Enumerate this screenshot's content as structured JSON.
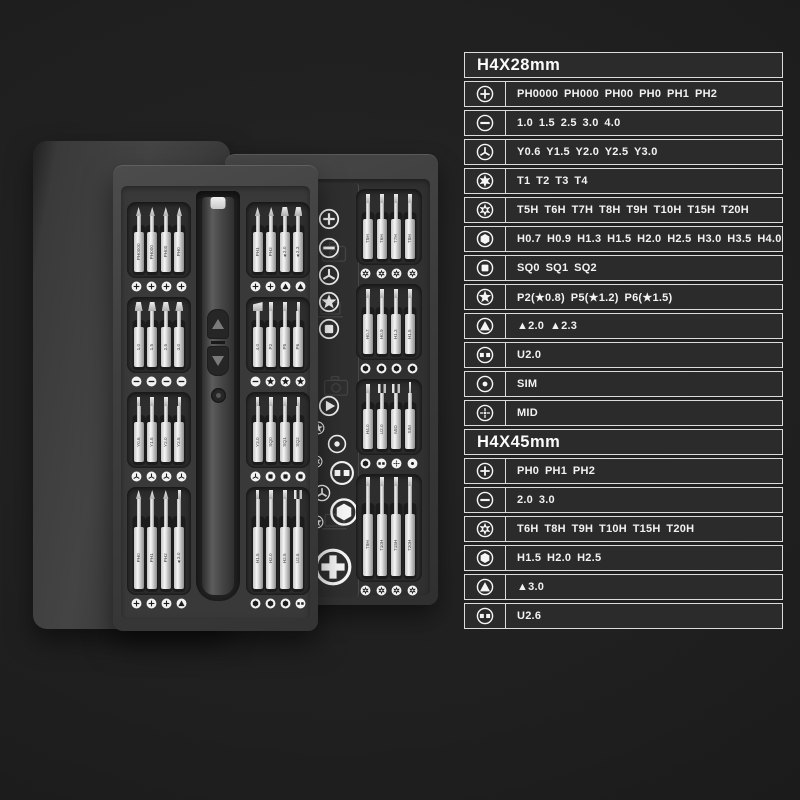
{
  "colors": {
    "background": "#1f1f1f",
    "case_panel": "#3a3a3a",
    "table_background": "#2b2b2b",
    "table_border": "#dcdcdc",
    "table_text": "#f2f2f2",
    "bit_metal": "#e8e8e8"
  },
  "product": {
    "spec_tables": [
      {
        "title": "H4X28mm",
        "rows": [
          {
            "icon": "phillips",
            "text": "PH0000 PH000 PH00 PH0 PH1 PH2"
          },
          {
            "icon": "slotted",
            "text": "1.0 1.5 2.5 3.0 4.0"
          },
          {
            "icon": "y-type",
            "text": "Y0.6 Y1.5 Y2.0 Y2.5 Y3.0"
          },
          {
            "icon": "torx",
            "text": "T1 T2 T3 T4"
          },
          {
            "icon": "torx-security",
            "text": "T5H T6H T7H T8H T9H T10H T15H T20H"
          },
          {
            "icon": "hex",
            "text": "H0.7 H0.9 H1.3 H1.5 H2.0 H2.5 H3.0 H3.5 H4.0"
          },
          {
            "icon": "square",
            "text": "SQ0 SQ1 SQ2"
          },
          {
            "icon": "pentalobe",
            "text": "P2(★0.8) P5(★1.2) P6(★1.5)"
          },
          {
            "icon": "triangle",
            "text": "▲2.0 ▲2.3"
          },
          {
            "icon": "u-type",
            "text": "U2.0"
          },
          {
            "icon": "sim",
            "text": "SIM"
          },
          {
            "icon": "mid",
            "text": "MID"
          }
        ]
      },
      {
        "title": "H4X45mm",
        "rows": [
          {
            "icon": "phillips",
            "text": "PH0 PH1 PH2"
          },
          {
            "icon": "slotted",
            "text": "2.0 3.0"
          },
          {
            "icon": "torx-security",
            "text": "T6H T8H T9H T10H T15H T20H"
          },
          {
            "icon": "hex",
            "text": "H1.5 H2.0 H2.5"
          },
          {
            "icon": "triangle",
            "text": "▲3.0"
          },
          {
            "icon": "u-type",
            "text": "U2.6"
          }
        ]
      }
    ],
    "front_case": {
      "left_rows": [
        {
          "tall": false,
          "bits": [
            {
              "label": "PH0000",
              "tip": "point",
              "icon": "phillips"
            },
            {
              "label": "PH000",
              "tip": "point",
              "icon": "phillips"
            },
            {
              "label": "PH00",
              "tip": "point",
              "icon": "phillips"
            },
            {
              "label": "PH0",
              "tip": "point",
              "icon": "phillips"
            }
          ]
        },
        {
          "tall": false,
          "bits": [
            {
              "label": "1.0",
              "tip": "flat",
              "icon": "slotted"
            },
            {
              "label": "1.5",
              "tip": "flat",
              "icon": "slotted"
            },
            {
              "label": "2.5",
              "tip": "flat",
              "icon": "slotted"
            },
            {
              "label": "3.0",
              "tip": "flat",
              "icon": "slotted"
            }
          ]
        },
        {
          "tall": false,
          "bits": [
            {
              "label": "Y0.6",
              "tip": "rod",
              "icon": "y-type"
            },
            {
              "label": "Y1.5",
              "tip": "rod",
              "icon": "y-type"
            },
            {
              "label": "Y2.0",
              "tip": "rod",
              "icon": "y-type"
            },
            {
              "label": "Y2.5",
              "tip": "rod",
              "icon": "y-type"
            }
          ]
        },
        {
          "tall": true,
          "bits": [
            {
              "label": "PH0",
              "tip": "point",
              "icon": "phillips"
            },
            {
              "label": "PH1",
              "tip": "point",
              "icon": "phillips"
            },
            {
              "label": "PH2",
              "tip": "point",
              "icon": "phillips"
            },
            {
              "label": "▲3.0",
              "tip": "rod",
              "icon": "triangle"
            }
          ]
        }
      ],
      "right_rows": [
        {
          "tall": false,
          "bits": [
            {
              "label": "PH1",
              "tip": "point",
              "icon": "phillips"
            },
            {
              "label": "PH2",
              "tip": "point",
              "icon": "phillips"
            },
            {
              "label": "▲2.0",
              "tip": "flat",
              "icon": "triangle"
            },
            {
              "label": "▲2.3",
              "tip": "flat",
              "icon": "triangle"
            }
          ]
        },
        {
          "tall": false,
          "bits": [
            {
              "label": "4.0",
              "tip": "chisel",
              "icon": "slotted"
            },
            {
              "label": "P2",
              "tip": "rod",
              "icon": "pentalobe"
            },
            {
              "label": "P5",
              "tip": "rod",
              "icon": "pentalobe"
            },
            {
              "label": "P6",
              "tip": "rod",
              "icon": "pentalobe"
            }
          ]
        },
        {
          "tall": false,
          "bits": [
            {
              "label": "Y3.0",
              "tip": "rod",
              "icon": "y-type"
            },
            {
              "label": "SQ0",
              "tip": "rod",
              "icon": "square"
            },
            {
              "label": "SQ1",
              "tip": "rod",
              "icon": "square"
            },
            {
              "label": "SQ2",
              "tip": "rod",
              "icon": "square"
            }
          ]
        },
        {
          "tall": true,
          "bits": [
            {
              "label": "H1.5",
              "tip": "rod",
              "icon": "hex"
            },
            {
              "label": "H2.0",
              "tip": "rod",
              "icon": "hex"
            },
            {
              "label": "H2.5",
              "tip": "rod",
              "icon": "hex"
            },
            {
              "label": "U2.6",
              "tip": "fork",
              "icon": "u-type"
            }
          ]
        }
      ]
    },
    "back_case": {
      "icon_strip": [
        "phillips",
        "slotted",
        "y-type",
        "star",
        "square"
      ],
      "deco_icons": [
        "play",
        "pentalobe",
        "sim",
        "torx-security",
        "u-type",
        "y-type",
        "hex",
        "pentalobe",
        "plus-big"
      ],
      "device_outlines": [
        "camera",
        "laptop",
        "camera",
        "laptop"
      ],
      "rows": [
        {
          "tall": false,
          "bits": [
            {
              "label": "T5H",
              "tip": "rod",
              "icon": "torx-security"
            },
            {
              "label": "T6H",
              "tip": "rod",
              "icon": "torx-security"
            },
            {
              "label": "T7H",
              "tip": "rod",
              "icon": "torx-security"
            },
            {
              "label": "T8H",
              "tip": "rod",
              "icon": "torx-security"
            }
          ]
        },
        {
          "tall": false,
          "bits": [
            {
              "label": "H0.7",
              "tip": "rod",
              "icon": "hex"
            },
            {
              "label": "H0.9",
              "tip": "rod",
              "icon": "hex"
            },
            {
              "label": "H1.3",
              "tip": "rod",
              "icon": "hex"
            },
            {
              "label": "H1.5",
              "tip": "rod",
              "icon": "hex"
            }
          ]
        },
        {
          "tall": false,
          "bits": [
            {
              "label": "H4.0",
              "tip": "rod",
              "icon": "hex"
            },
            {
              "label": "U2.0",
              "tip": "fork",
              "icon": "u-type"
            },
            {
              "label": "MID",
              "tip": "fork",
              "icon": "mid"
            },
            {
              "label": "SIM",
              "tip": "pin",
              "icon": "sim"
            }
          ]
        },
        {
          "tall": true,
          "bits": [
            {
              "label": "T9H",
              "tip": "rod",
              "icon": "torx-security"
            },
            {
              "label": "T10H",
              "tip": "rod",
              "icon": "torx-security"
            },
            {
              "label": "T15H",
              "tip": "rod",
              "icon": "torx-security"
            },
            {
              "label": "T20H",
              "tip": "rod",
              "icon": "torx-security"
            }
          ]
        }
      ]
    }
  }
}
